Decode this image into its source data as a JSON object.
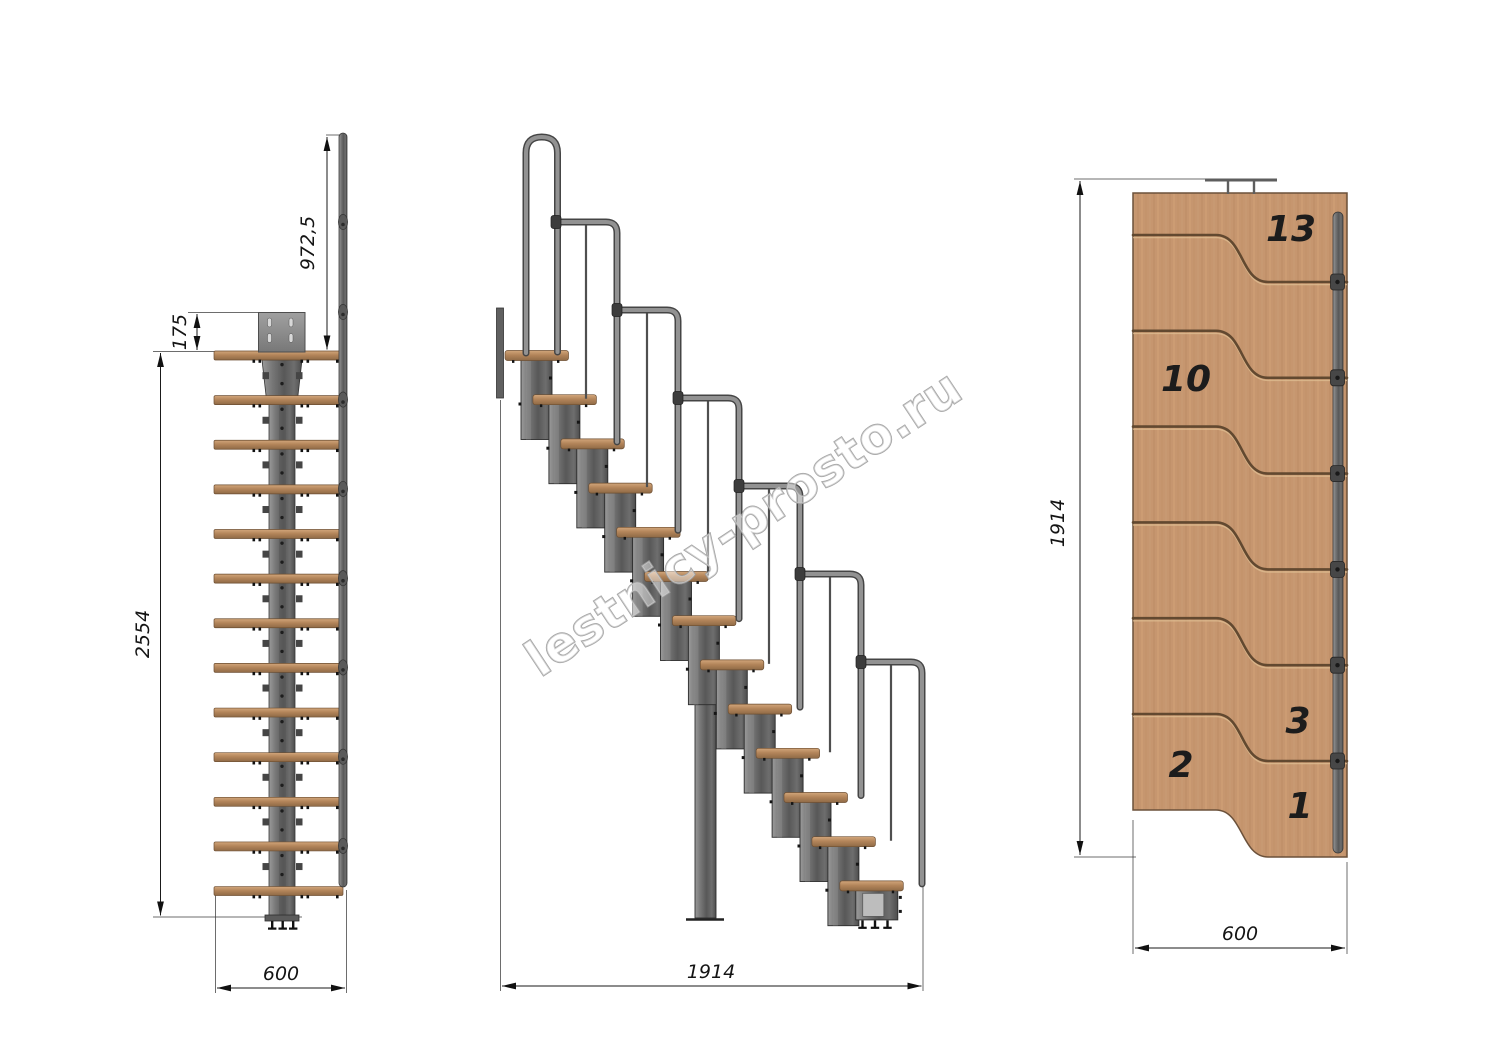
{
  "watermark": {
    "text": "lestnicy-prosto.ru"
  },
  "front_view": {
    "dims": {
      "rail_height": "972,5",
      "plate_offset": "175",
      "total_height": "2554",
      "width": "600"
    }
  },
  "side_view": {
    "dims": {
      "length": "1914"
    }
  },
  "plan_view": {
    "dims": {
      "length": "1914",
      "width": "600"
    },
    "step_labels": {
      "n13": "13",
      "n10": "10",
      "n3": "3",
      "n2": "2",
      "n1": "1"
    }
  }
}
